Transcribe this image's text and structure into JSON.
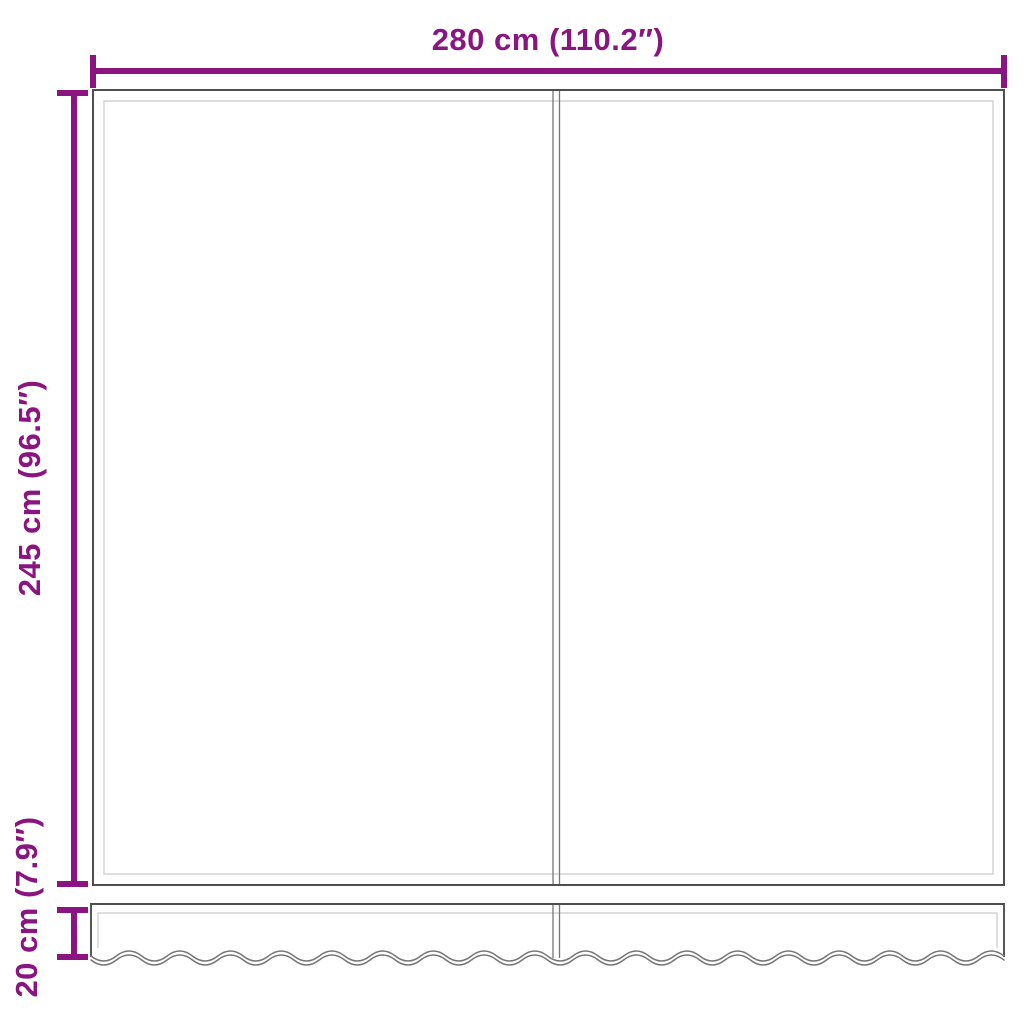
{
  "dimensions": {
    "width": {
      "label": "280 cm (110.2″)"
    },
    "height": {
      "label": "245 cm (96.5″)"
    },
    "valance_height": {
      "label": "20 cm (7.9″)"
    }
  },
  "colors": {
    "dimension": "#8a1580",
    "outline_dark": "#4e4e4e",
    "outline_mid": "#767676",
    "outline_light": "#c9c9c9",
    "background": "#ffffff"
  }
}
